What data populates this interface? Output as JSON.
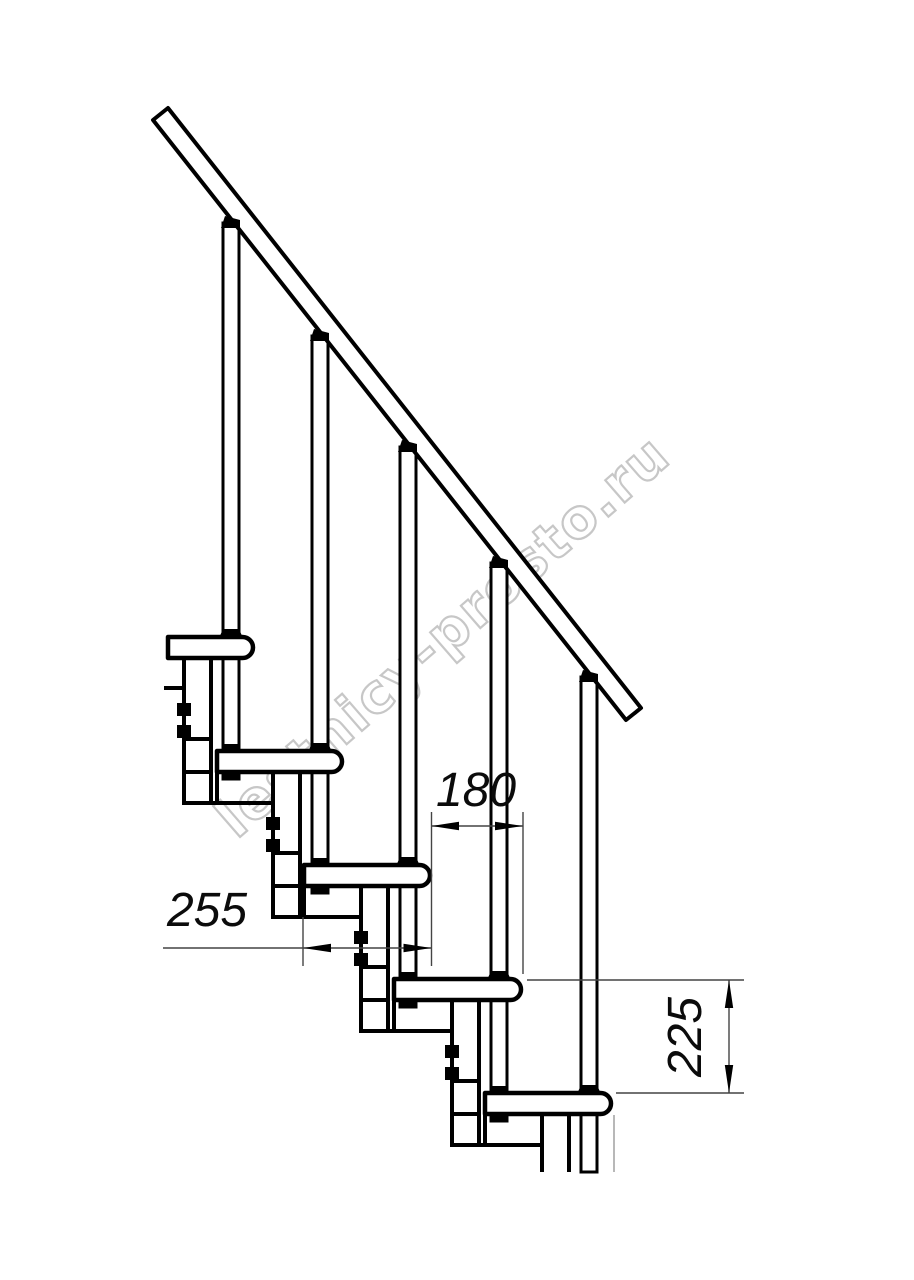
{
  "watermark": {
    "text": "lestnicy-prosto.ru"
  },
  "dimensions": {
    "horizontal_upper": "180",
    "horizontal_lower": "255",
    "vertical": "225"
  },
  "colors": {
    "line": "#000000",
    "thin_line": "#444444",
    "watermark": "#c7c7c7",
    "background": "#ffffff"
  }
}
